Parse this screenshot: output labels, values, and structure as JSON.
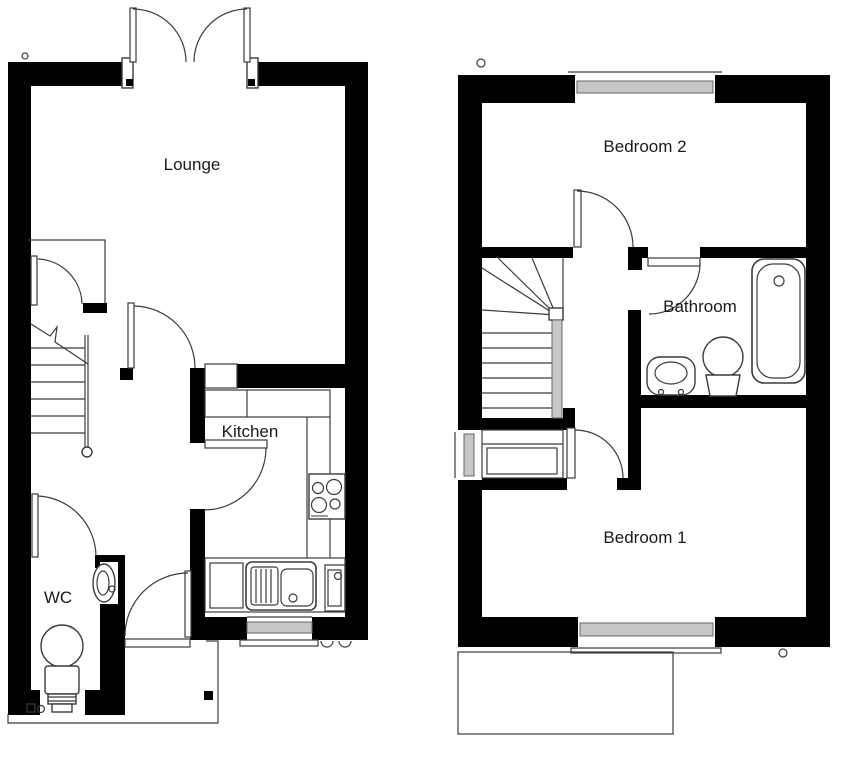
{
  "labels": {
    "lounge": "Lounge",
    "kitchen": "Kitchen",
    "wc": "WC",
    "bedroom2": "Bedroom 2",
    "bathroom": "Bathroom",
    "bedroom1": "Bedroom 1"
  },
  "colors": {
    "wall": "#000000",
    "line": "#3b3b3b",
    "glazing": "#c6c6c6",
    "background": "#ffffff",
    "text": "#1a1a1a"
  },
  "fixtures": {
    "ground_floor": [
      "french-doors",
      "stairs",
      "understairs-cupboard",
      "wc-toilet",
      "wc-basin",
      "front-door",
      "kitchen-sink",
      "hob",
      "appliance",
      "kitchen-window",
      "patio-outline"
    ],
    "first_floor": [
      "window-bedroom2",
      "stairs",
      "airing-cupboard",
      "side-window",
      "bath",
      "bathroom-basin",
      "bathroom-toilet",
      "window-bedroom1",
      "patio-outline"
    ]
  }
}
